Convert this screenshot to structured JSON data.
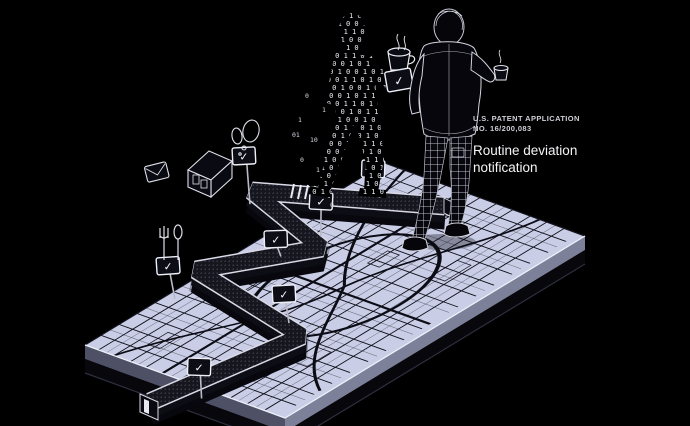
{
  "canvas": {
    "width": 690,
    "height": 426,
    "background": "#000000"
  },
  "caption": {
    "patent_label_line1": "U.S. PATENT APPLICATION",
    "patent_label_line2": "NO. 16/200,083",
    "title_line1": "Routine deviation",
    "title_line2": "notification"
  },
  "signs": {
    "glyph": "✓",
    "count": 7
  },
  "colors": {
    "background": "#000000",
    "map_fill": "#c9cde6",
    "street": "#10101a",
    "platform_side_right": "#7d8099",
    "platform_side_left": "#4e5166",
    "walkway_top": "#16161f",
    "walkway_edge": "#d9dae6",
    "caption_label": "#cfd0d8",
    "caption_title": "#f5f5f8"
  },
  "binary": {
    "row_a": "0 1 1 0 1 0 0 1 0 1 1 0 1 0 0 1 0 1 1 0 1",
    "row_b": "1 0 0 1 1 0 1 0 0 1 0 1 1 0 0 1 0 1 0 1 1",
    "row_c": "0 1 0 1 0 0 1 1 0 1 0 1 0 0 1 1 0 1 0 0 1",
    "strays": [
      "0",
      "1",
      "10",
      "0",
      "1",
      "01",
      "1",
      "0"
    ]
  },
  "icons": [
    {
      "name": "house-icon"
    },
    {
      "name": "utensils-icon"
    },
    {
      "name": "speech-bubble-icon"
    },
    {
      "name": "message-icon"
    },
    {
      "name": "coffee-cup-icon"
    },
    {
      "name": "coffee-cup-small-icon"
    },
    {
      "name": "notification-card-icon"
    },
    {
      "name": "checkmark-sign-icon"
    }
  ],
  "scene_elements": [
    {
      "name": "city-map-platform"
    },
    {
      "name": "elevated-route-walkway"
    },
    {
      "name": "binary-person-figure"
    },
    {
      "name": "walking-man-figure"
    }
  ]
}
